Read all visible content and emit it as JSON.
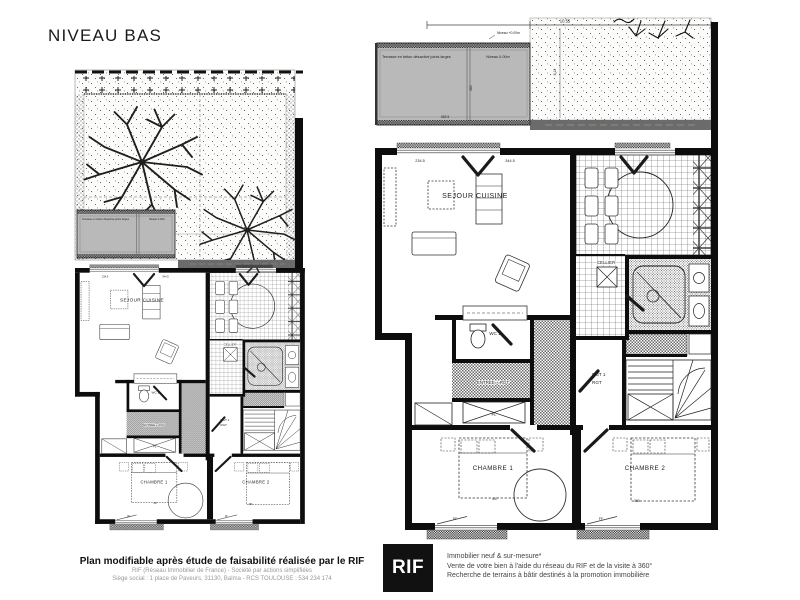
{
  "page": {
    "title": "NIVEAU BAS"
  },
  "plan": {
    "labels": {
      "sejour": "SEJOUR CUISINE",
      "wc": "WC 1",
      "cellier": "CELLIER",
      "entree": "ENTREE + RGT",
      "dgt1": "DGT 1",
      "dgt2": "RGT",
      "pl": "PL",
      "chambre1": "CHAMBRE 1",
      "chambre2": "CHAMBRE 2",
      "ff": "FF"
    },
    "dims": {
      "a": "234.5",
      "b": "344.5",
      "c": "437",
      "d": "360"
    }
  },
  "terrace": {
    "label": "Terrasse en béton désactivé joints larges",
    "niveau": "Niveau 0.00m",
    "dim_w": "453.5",
    "dim_h": "280"
  },
  "garden": {
    "dim_total": "10.55",
    "niveau": "Niveau +0.00m",
    "dim_side": "8.12"
  },
  "footer": {
    "headline": "Plan modifiable après étude de faisabilité réalisée par le RIF",
    "sub1": "RIF (Réseau Immobilier de France) - Société par actions simplifiées",
    "sub2": "Siège social : 1 place de Paveurs, 31130, Balma - RCS TOULOUSE : 534 234 174",
    "logo": "RIF",
    "services": [
      "Immobilier neuf & sur-mesure*",
      "Vente de votre bien à l'aide du réseau du RIF et de la visite à 360°",
      "Recherche de terrains à bâtir destinés à la promotion immobilière"
    ]
  },
  "colors": {
    "ink": "#111111",
    "terrace_gray": "#b9b9b9",
    "fence_gray": "#6b6b6b",
    "muted_text": "#999999"
  }
}
